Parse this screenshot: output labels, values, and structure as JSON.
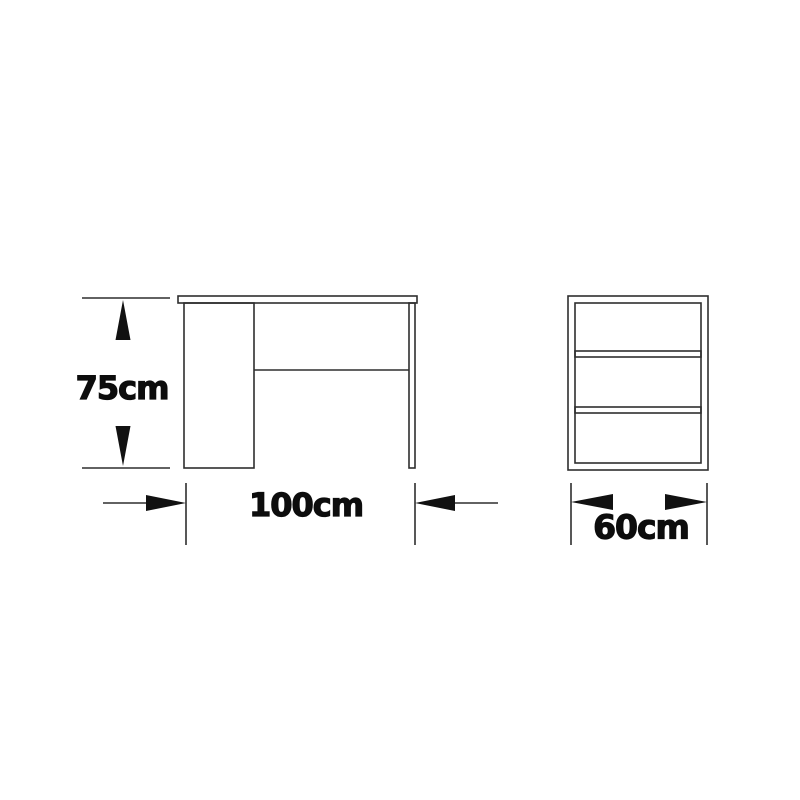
{
  "diagram": {
    "subject": "desk-dimension-drawing",
    "views": [
      {
        "id": "front",
        "description": "desk front elevation with pedestal, back panel and right leg"
      },
      {
        "id": "side",
        "description": "side elevation with two shelves"
      }
    ],
    "dimensions": {
      "height": {
        "label": "75cm",
        "value": 75,
        "unit": "cm"
      },
      "width": {
        "label": "100cm",
        "value": 100,
        "unit": "cm"
      },
      "depth": {
        "label": "60cm",
        "value": 60,
        "unit": "cm"
      }
    },
    "colors": {
      "line": "#2e2e2e",
      "arrow": "#111111",
      "text": "#0d0d0d",
      "background": "#ffffff"
    }
  }
}
